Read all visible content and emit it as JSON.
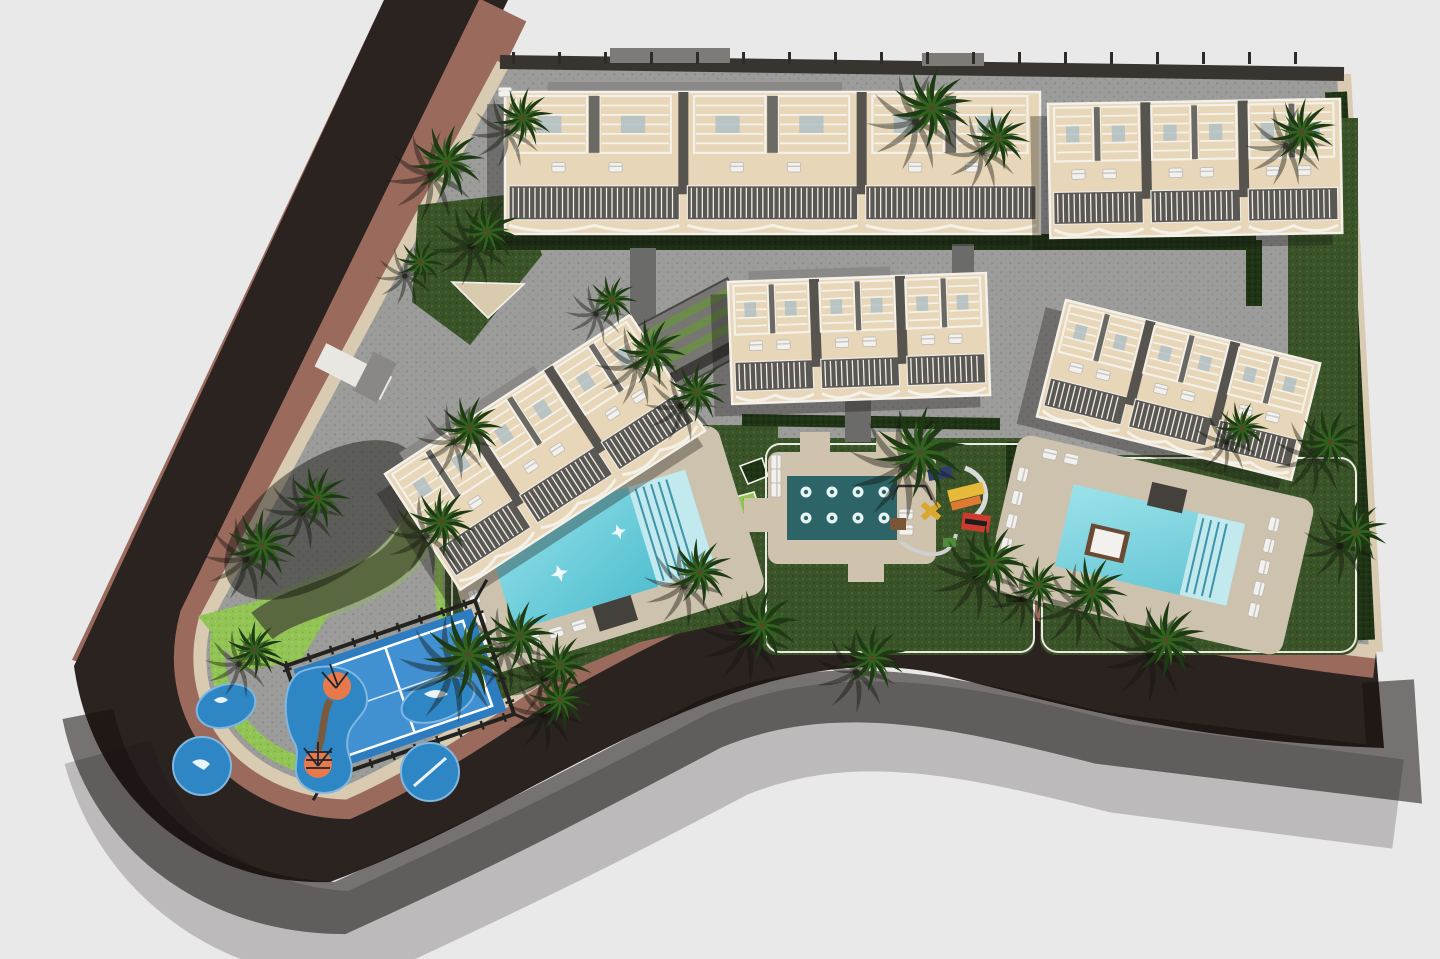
{
  "scene": {
    "description": "Aerial 3D architectural render of a residential development site plan with apartment blocks, pools, padel court, playground and palm trees",
    "colors": {
      "background": "#e9e9ea",
      "road": "#2a2320",
      "road_shadow": "#16110d",
      "sidewalk_brown": "#9a6a5c",
      "boundary_wall_beige": "#d9cbb2",
      "paving_gray": "#9c9c9a",
      "paving_dot": "#8a8a8e",
      "lawn_green": "#3a5329",
      "hedge_dark": "#1f3315",
      "lime_grass": "#92c455",
      "building_terrace": "#e7d6b8",
      "pergola_white": "#f4f1ea",
      "balcony_gray": "#5b5854",
      "roof_gray": "#8b8987",
      "pool_water": "#62cfdc",
      "pool_deep": "#2e6f85",
      "pool_steps": "#c2e9ed",
      "pool_deck": "#cdc2ad",
      "top_pool_deck": "#55555a",
      "spa_water": "#2c6468",
      "padel_blue": "#2e7cc0",
      "padel_inner": "#4090d2",
      "splash_blue": "#2f86c5",
      "splash_orange": "#e8794a",
      "palm_green": "#1e3a14",
      "palm_light": "#33611f"
    },
    "inventory": {
      "residential_blocks": 6,
      "swimming_pools": 3,
      "spa_jet_pool": 1,
      "spa_jets": 8,
      "padel_courts": 1,
      "splash_pad_islands": 5,
      "palm_trees": 30,
      "sun_loungers": "multiple rows around each pool and on every roof terrace"
    },
    "element_names": {
      "road": "perimeter-road",
      "sidewalk": "brown-sidewalk-band",
      "site": "paved-site-area",
      "building": "residential-block",
      "pool": "swimming-pool",
      "spa": "spa-jet-pool",
      "court": "padel-court",
      "splash": "splash-pad",
      "palm": "palm-tree",
      "lounger": "sun-lounger"
    }
  }
}
